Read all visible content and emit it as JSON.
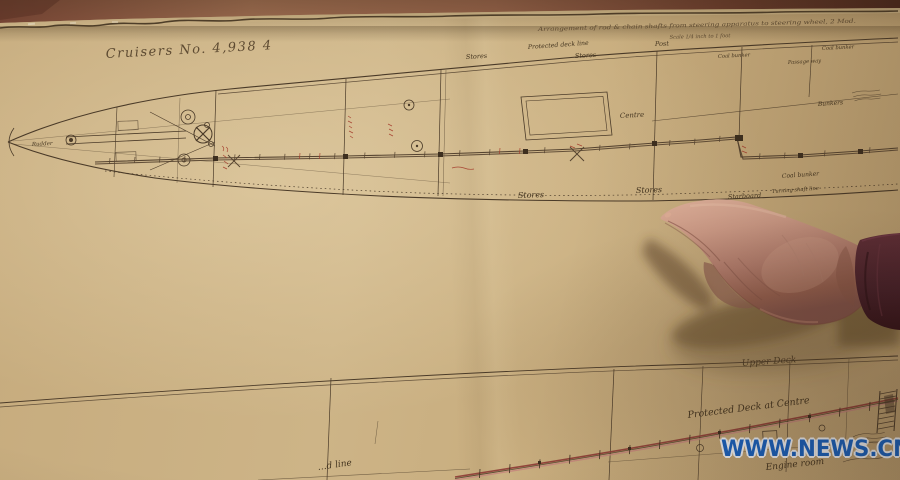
{
  "photo": {
    "watermark": "WWW.NEWS.CN",
    "colors": {
      "paper_tan": "#c8ad7e",
      "ink_sepia": "#4a3a28",
      "annotation_red": "#a43a2a",
      "protected_deck_red": "#8c3a34",
      "sleeve_maroon": "#4e2228",
      "watermark_blue": "#1763c4",
      "table_wood": "#8a5a44"
    }
  },
  "blueprint": {
    "title": "Cruisers No. 4,938 4",
    "header": {
      "line1": "Arrangement of rod & chain shafts from steering apparatus to steering wheel, 2 Mod.",
      "line2": "Scale 1/4 inch to 1 foot"
    },
    "plan_labels": {
      "rudder": "Rudder",
      "protected_deck_line": "Protected deck line",
      "post": "Post",
      "stores_upper_left": "Stores",
      "stores_upper_right": "Stores",
      "coal_bunker_top": "Coal bunker",
      "coal_bunker_right": "Coal bunker",
      "passage_way": "Passage way",
      "bunkers": "Bunkers",
      "centre": "Centre",
      "coal_bunker_lower": "Coal bunker",
      "turning_shaft_line": "Turning shaft line",
      "stores_lower_left": "Stores",
      "stores_lower_right": "Stores",
      "starboard": "Starboard"
    },
    "profile_labels": {
      "upper_deck": "Upper Deck",
      "protected_deck_at_centre": "Protected Deck at Centre",
      "engine_room": "Engine room",
      "line_fragment": "…d line"
    }
  }
}
